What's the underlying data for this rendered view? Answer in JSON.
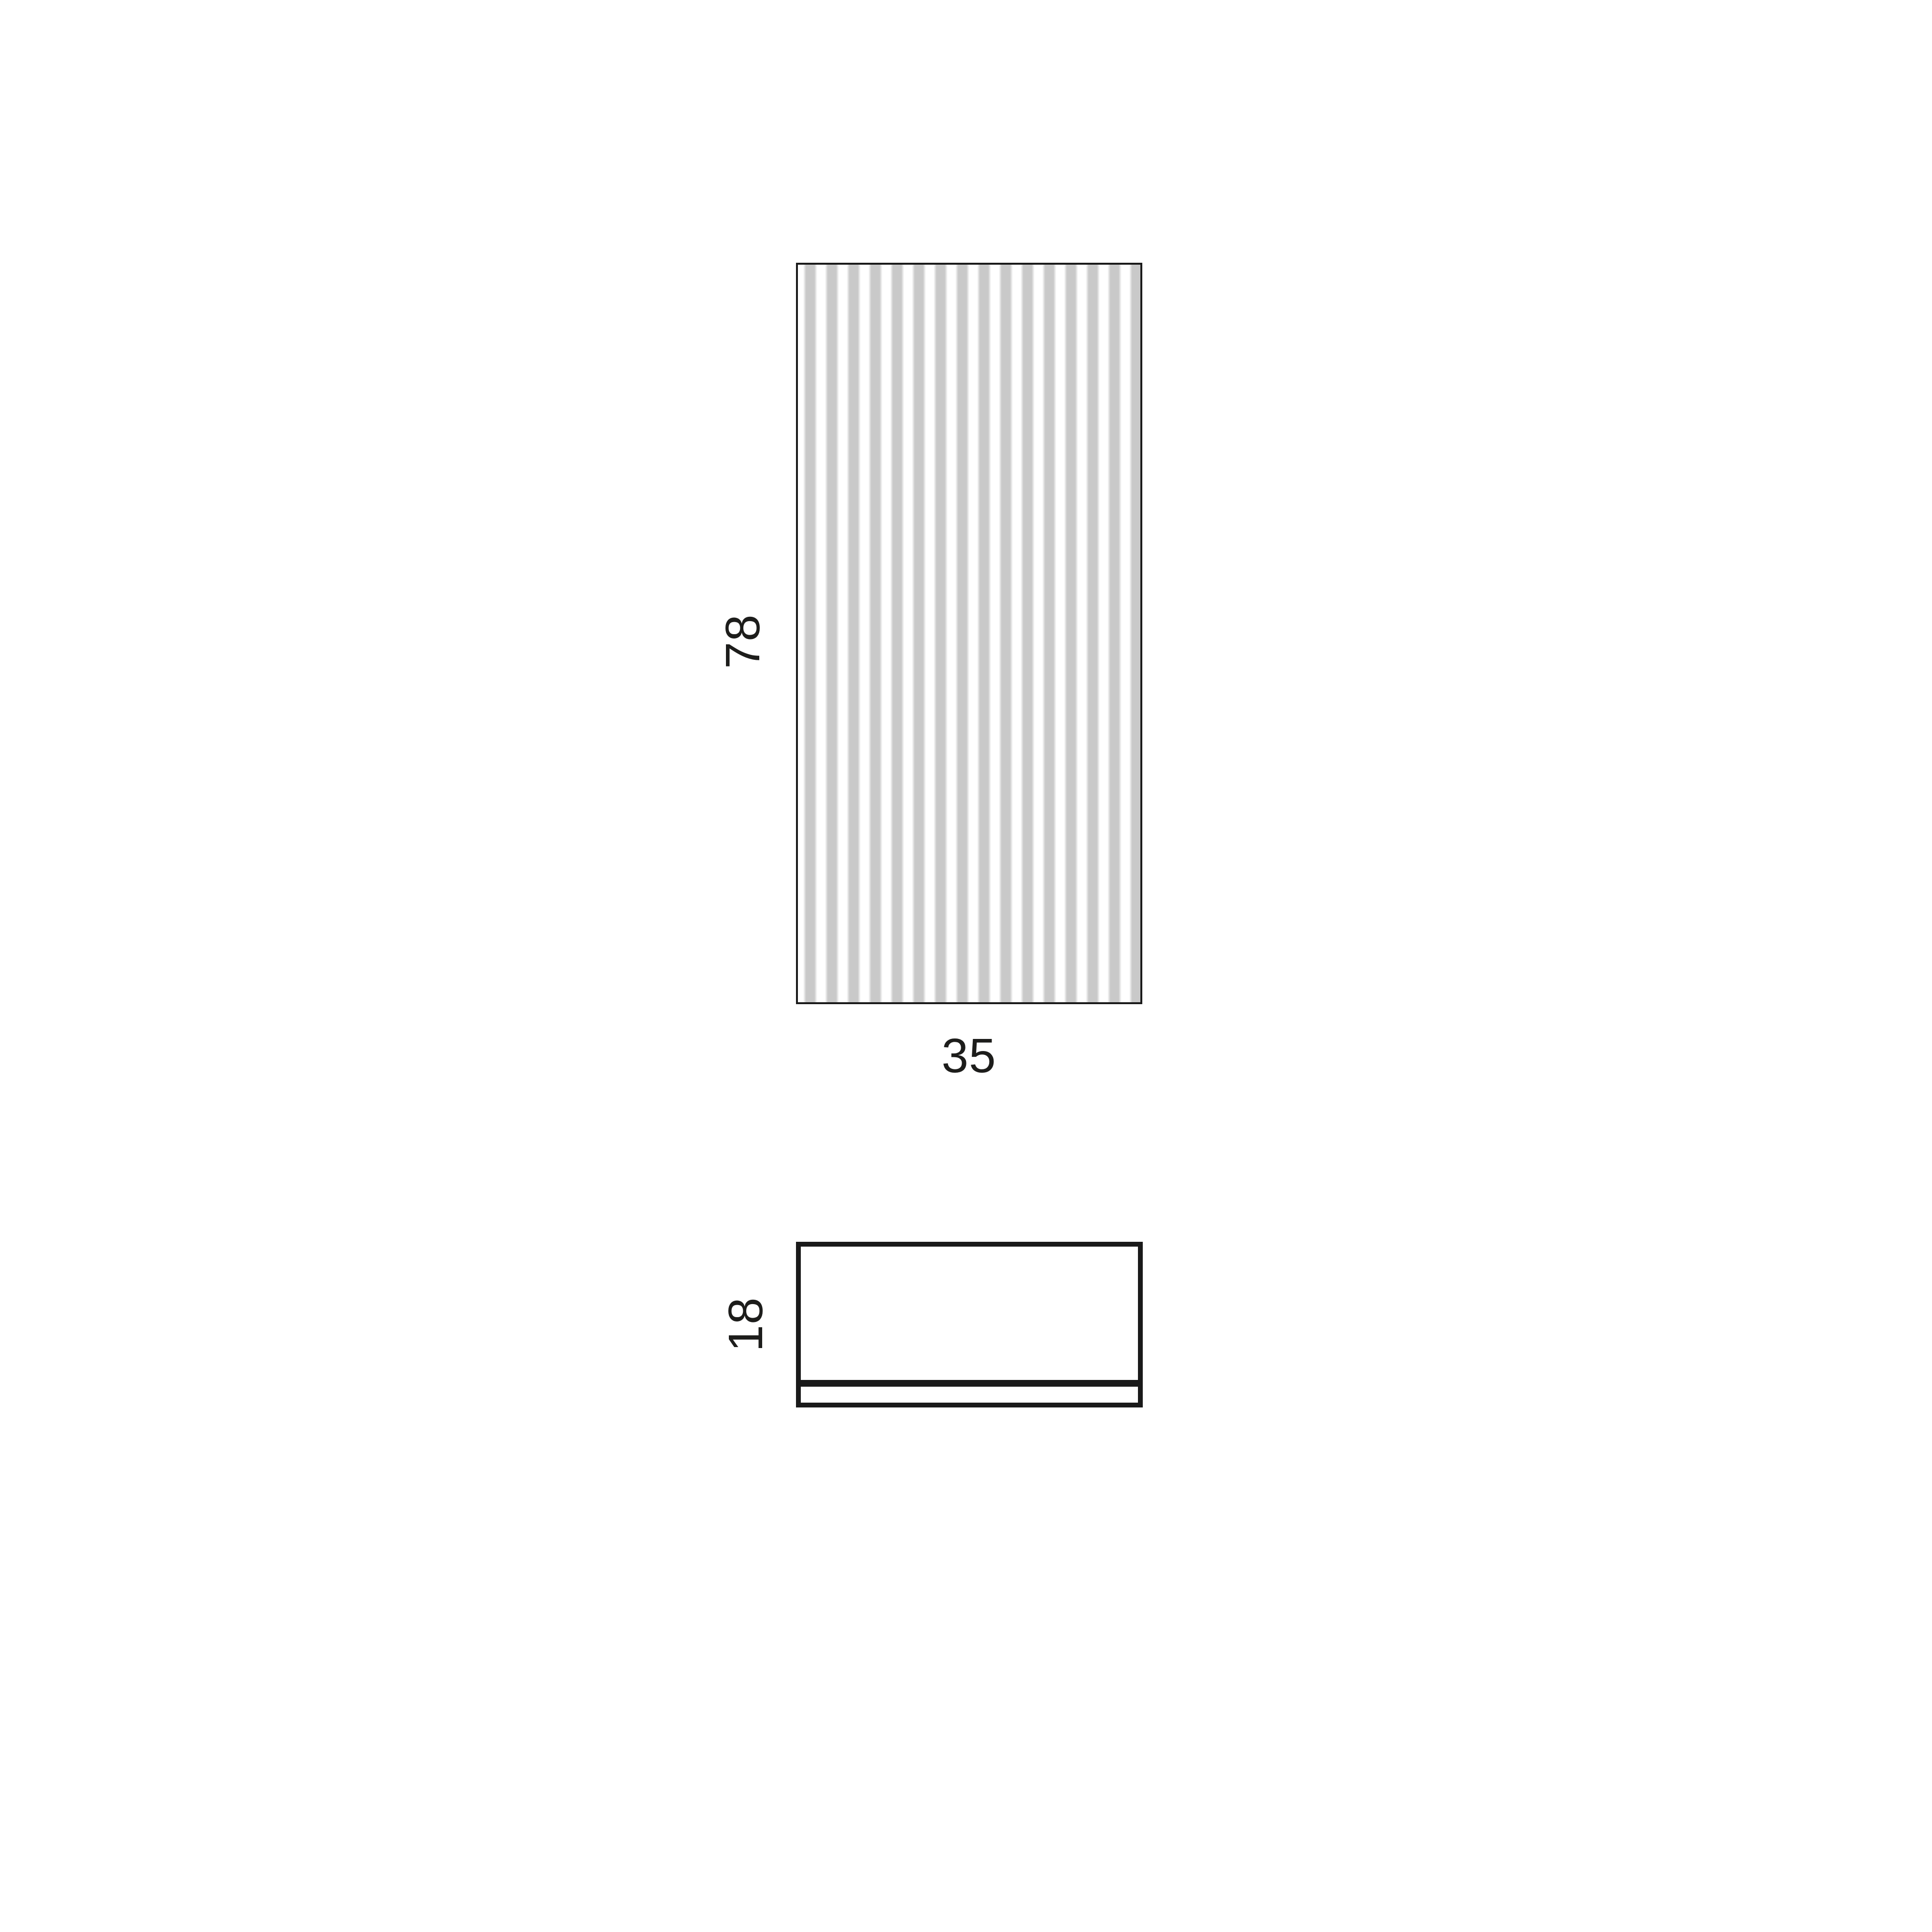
{
  "page": {
    "title": "Product dimension drawing",
    "background": "#ffffff"
  },
  "views": {
    "front": {
      "height_label": "78",
      "width_label": "35"
    },
    "side": {
      "height_label": "18"
    }
  },
  "colors": {
    "outline": "#1a1a1a",
    "stripe": "#c9c9c9",
    "text": "#1d1d1b",
    "bg": "#ffffff"
  }
}
